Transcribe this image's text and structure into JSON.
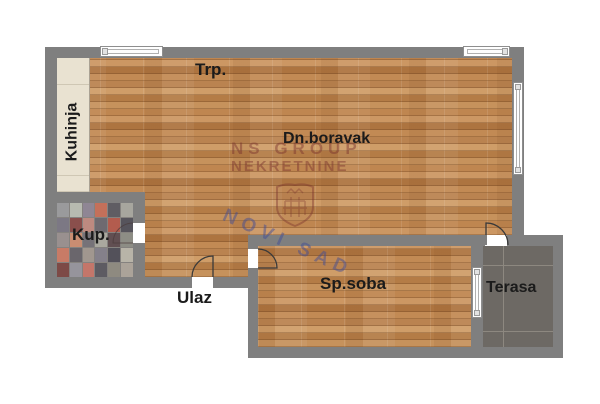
{
  "plan": {
    "type": "apartment-floor-plan",
    "rooms": {
      "kitchen": {
        "label": "Kuhinja"
      },
      "dining": {
        "label": "Trp."
      },
      "living_room": {
        "label": "Dn.boravak"
      },
      "bathroom": {
        "label": "Kup."
      },
      "entrance": {
        "label": "Ulaz"
      },
      "bedroom": {
        "label": "Sp.soba"
      },
      "terrace": {
        "label": "Terasa"
      }
    }
  },
  "watermark": {
    "line1": "NS GROUP",
    "line2": "NEKRETNINE",
    "line3": "NOVI SAD",
    "emblem": "novi-sad-crest"
  },
  "colors": {
    "wall": "#7f7f7f",
    "wood_base": "#c08a55",
    "kitchen_tile": "#e9e2d1",
    "terrace_tile": "#6d6964",
    "label_text": "#1b1b1b",
    "watermark_maroon": "rgba(120,48,44,0.45)",
    "watermark_blue": "rgba(62,76,150,0.48)",
    "bathroom_palette": [
      "#9a9a9c",
      "#b7bab0",
      "#8f8694",
      "#c4705a",
      "#5f5d63",
      "#a7a69e",
      "#7c7884",
      "#8a4f4c",
      "#bd8a80",
      "#6e6a70",
      "#b35c4e",
      "#56545c",
      "#99908f",
      "#c98d72",
      "#767278",
      "#aaa89f",
      "#614f52",
      "#8d8d85",
      "#c87b66",
      "#6a666c",
      "#a1978f",
      "#84808a",
      "#53515a",
      "#b8b4a8",
      "#7d4a46",
      "#96949c",
      "#c4766a",
      "#5d5b62",
      "#8e8a80",
      "#aba399"
    ]
  }
}
